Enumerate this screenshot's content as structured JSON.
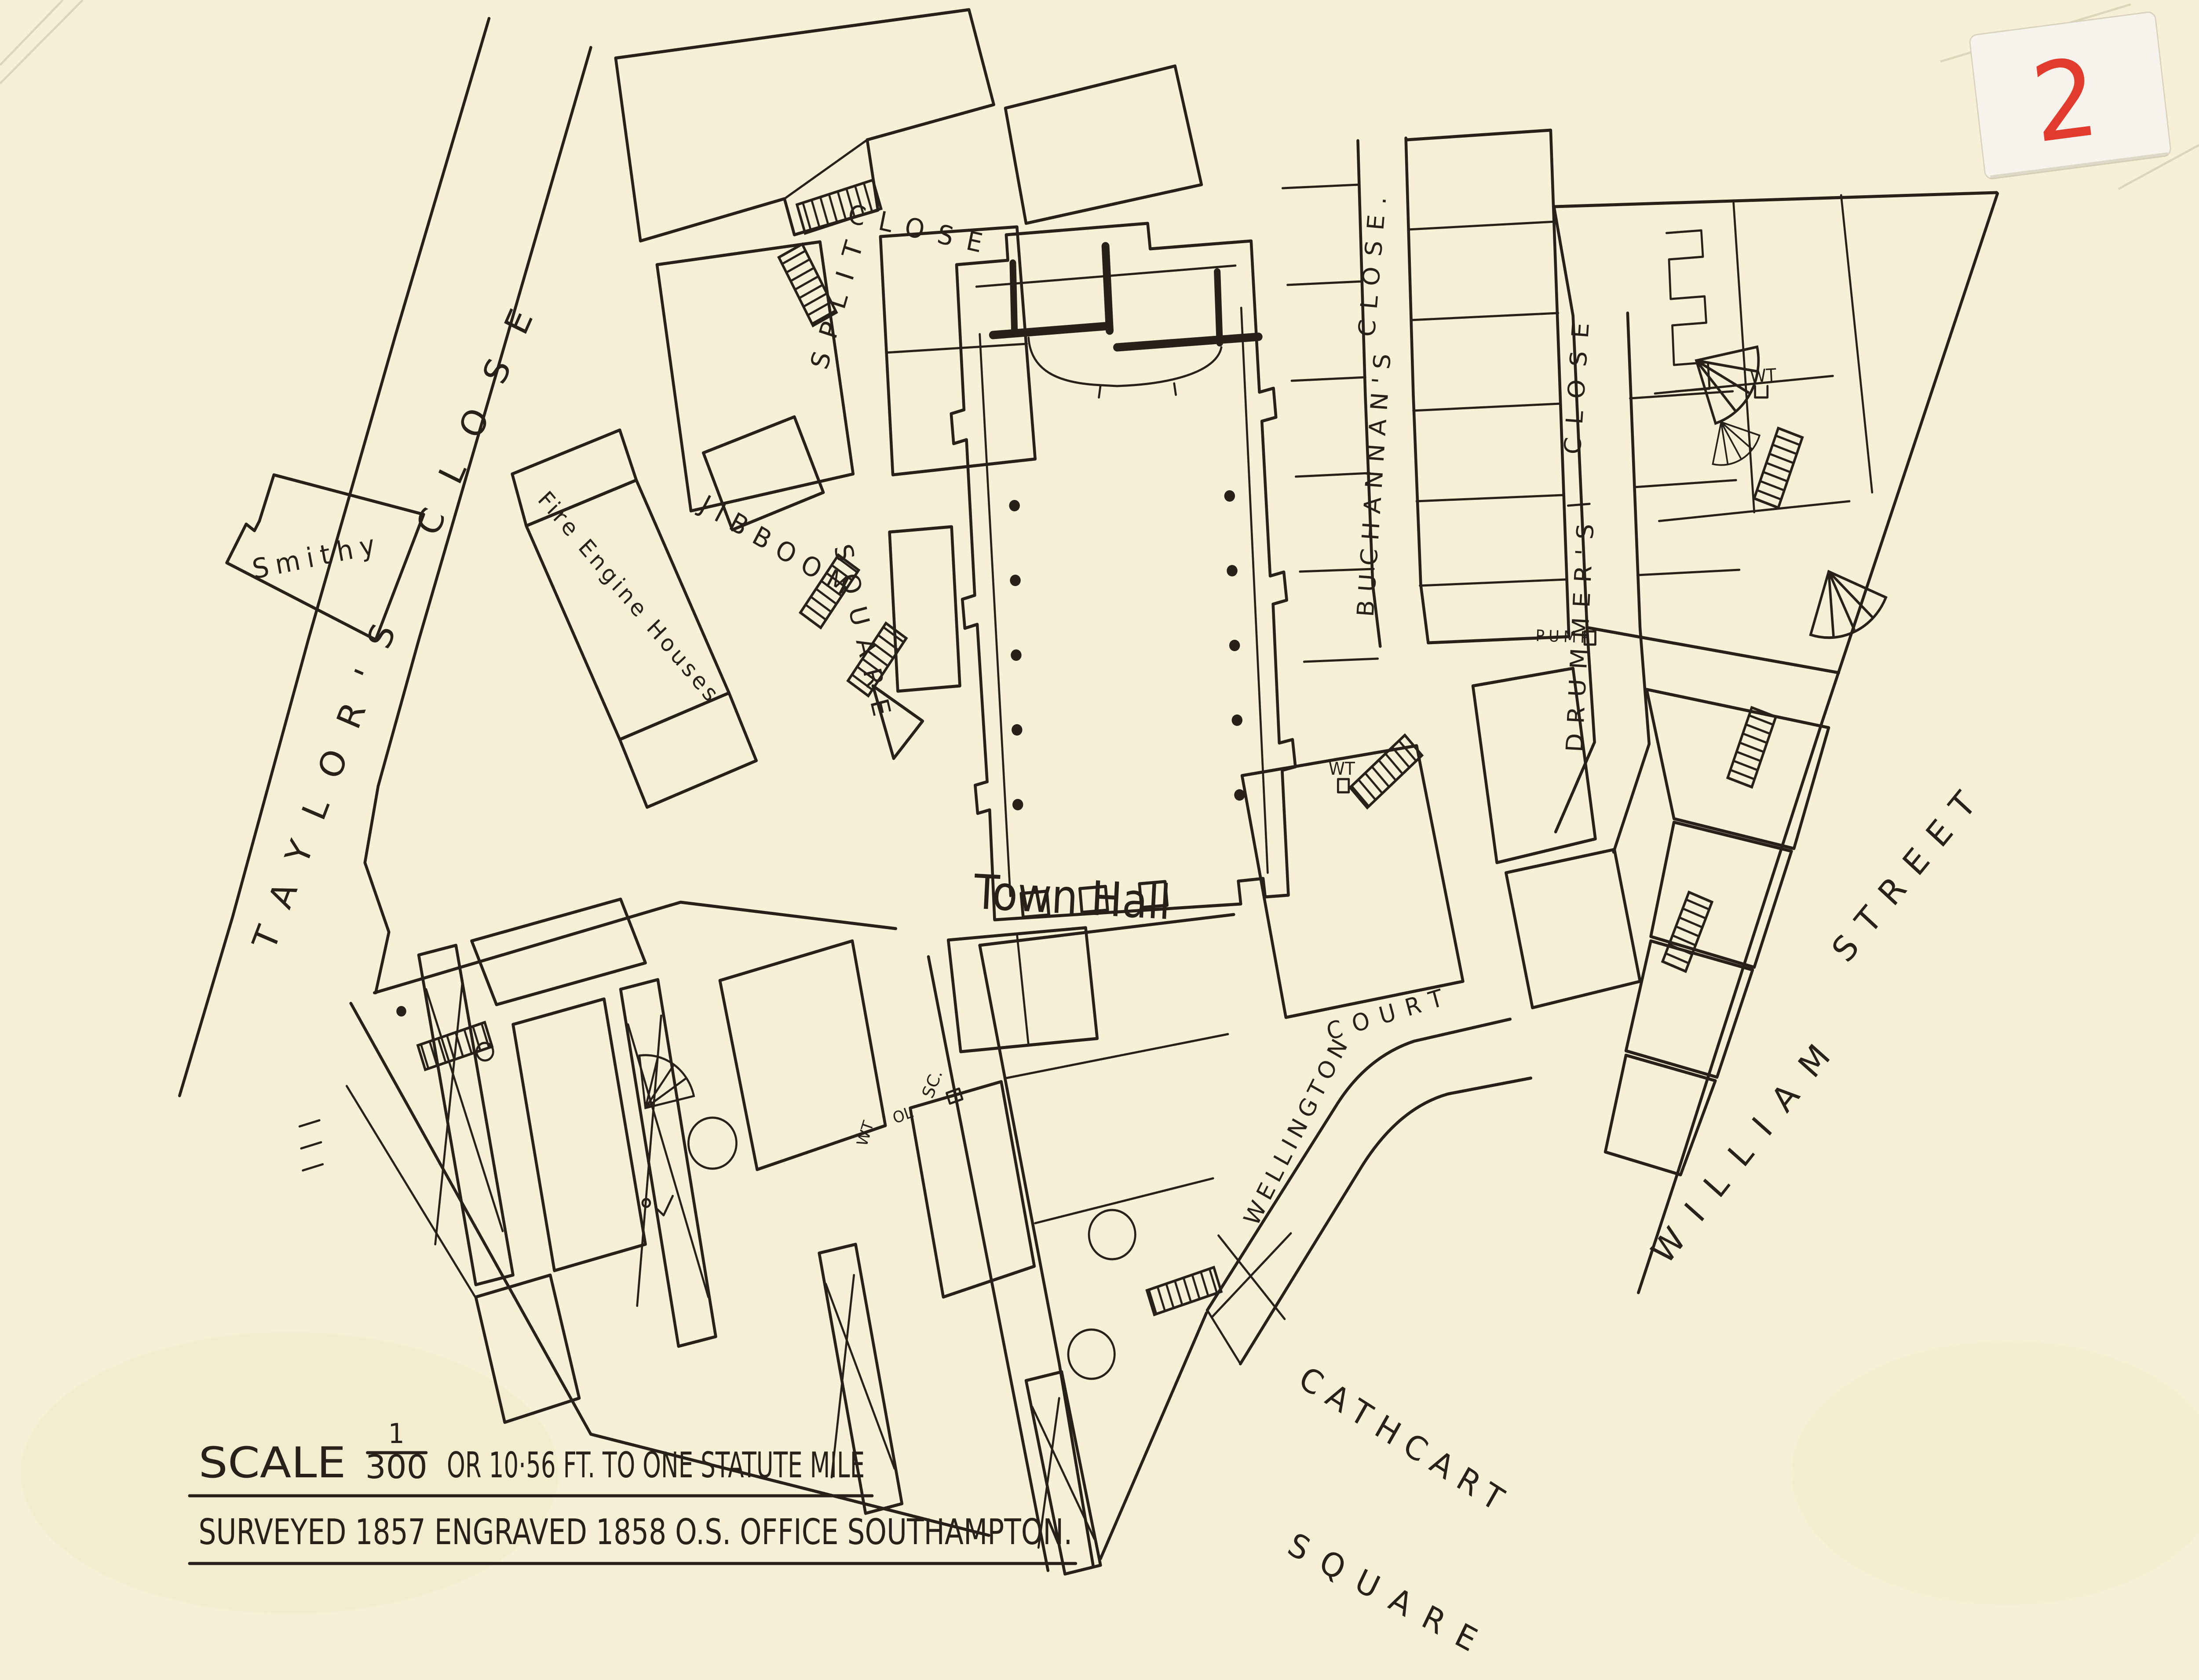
{
  "sheet_label": {
    "number": "2"
  },
  "scale_note": {
    "word_scale": "SCALE",
    "fraction_numerator": "1",
    "fraction_denominator": "300",
    "line1_rest": "OR 10·56 FT. TO ONE STATUTE MILE",
    "line2": "SURVEYED 1857 ENGRAVED 1858 O.S. OFFICE SOUTHAMPTON."
  },
  "streets": {
    "taylors_close": {
      "w1": "TAYLOR'S",
      "w2": "CLOSE"
    },
    "split_close": {
      "w1": "SPLIT",
      "w2": "CLOSE"
    },
    "jibboom_square": {
      "w1": "JIBBOOM",
      "w2": "SQUARE"
    },
    "buchannans_close": {
      "w1": "BUCHANNAN'S",
      "w2": "CLOSE."
    },
    "drummers_close": {
      "w1": "DRUMMER'S",
      "w2": "CLOSE"
    },
    "william_street": {
      "w1": "WILLIAM",
      "w2": "STREET"
    },
    "cathcart_square": {
      "w1": "CATHCART",
      "w2": "SQUARE"
    },
    "wellington_court": {
      "w1": "WELLINGTON",
      "w2": "COURT"
    }
  },
  "places": {
    "town_hall": "Town Hall",
    "smithy": "Smithy",
    "fire_engine_houses": "Fire Engine Houses",
    "pump": "PUMP"
  },
  "small_marks": {
    "water_tank_north": "WT",
    "water_tank_court": "WT",
    "water_tank_west": "WT",
    "stop_cock": "SC.",
    "mark_ol": "OL"
  },
  "colors": {
    "paper": "#f7f0d6",
    "ink": "#27211a",
    "sheet_number_red": "#e23b2e"
  }
}
